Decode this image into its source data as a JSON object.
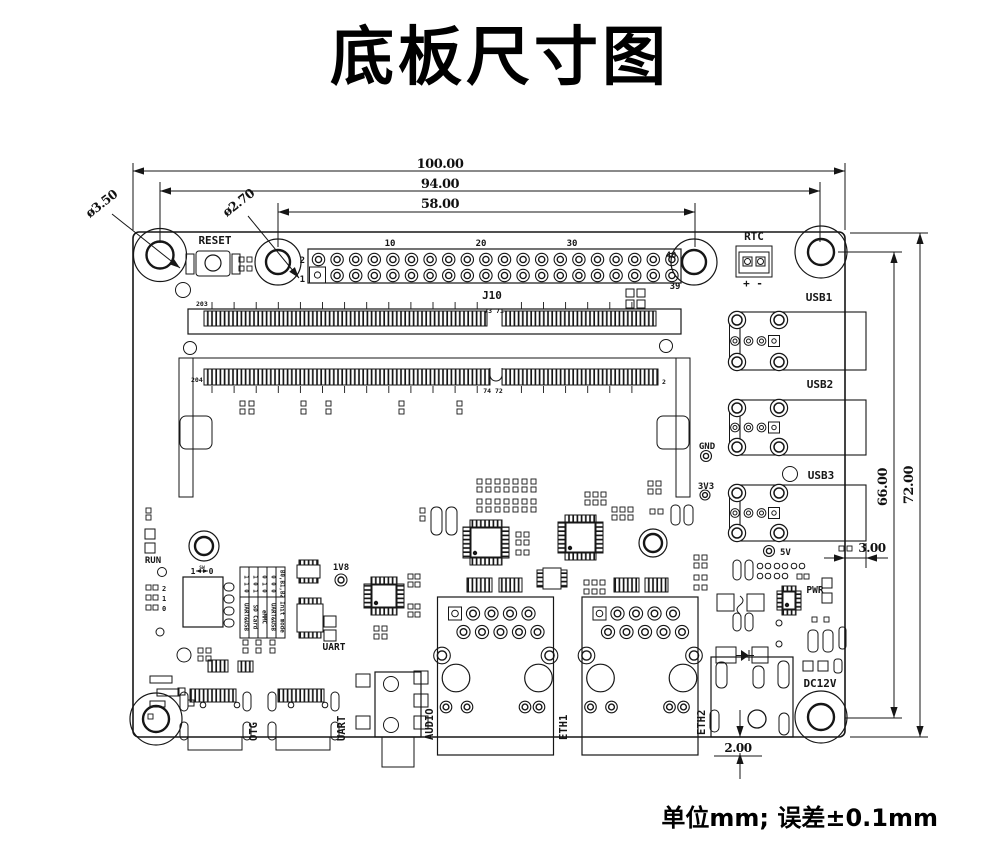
{
  "title": "底板尺寸图",
  "footnote": "单位mm; 误差±0.1mm",
  "dimensions": {
    "board_width": "100.00",
    "mount_hole_span": "94.00",
    "header_hole_span": "58.00",
    "board_height": "72.00",
    "right_hole_span": "66.00",
    "usb_overhang": "3.00",
    "eth_overhang": "2.00",
    "mount_hole_dia": "ø3.50",
    "header_hole_dia": "ø2.70"
  },
  "silkscreen": {
    "reset": "RESET",
    "rtc": "RTC",
    "rtc_polarity": "+ -",
    "usb1": "USB1",
    "usb2": "USB2",
    "usb3": "USB3",
    "gnd": "GND",
    "v3v3": "3V3",
    "v5": "5V",
    "v1v8": "1V8",
    "pwr": "PWR",
    "dc12v": "DC12V",
    "run": "RUN",
    "uart_ic": "UART",
    "otg": "OTG",
    "uart_port": "UART",
    "audio": "AUDIO",
    "eth1": "ETH1",
    "eth2": "ETH2",
    "sw_left": "1",
    "sw_mid": "SW",
    "sw_right": "0",
    "dip_2": "2",
    "dip_1": "1",
    "dip_0": "0"
  },
  "j10_pins": {
    "label": "J10",
    "top_left": "2",
    "bottom_left": "1",
    "p10": "10",
    "p20": "20",
    "p30": "30",
    "top_right": "40",
    "bottom_right": "39"
  },
  "sodimm_pins": {
    "top_left": "203",
    "top_mid": "73 71",
    "bottom_left": "204",
    "bottom_mid": "74 72",
    "bottom_right": "2"
  },
  "boot_table": {
    "header": {
      "bits": "B0,B1,B2",
      "mode": "Init mode"
    },
    "rows": [
      {
        "bits": "0 0 0",
        "mode": "UART&USB"
      },
      {
        "bits": "0 1 0",
        "mode": "eMMC"
      },
      {
        "bits": "1 0 1",
        "mode": "SD Card"
      },
      {
        "bits": "1 1 0",
        "mode": "UART&USB"
      }
    ]
  },
  "colors": {
    "ink": "#161616",
    "paper": "#ffffff"
  }
}
